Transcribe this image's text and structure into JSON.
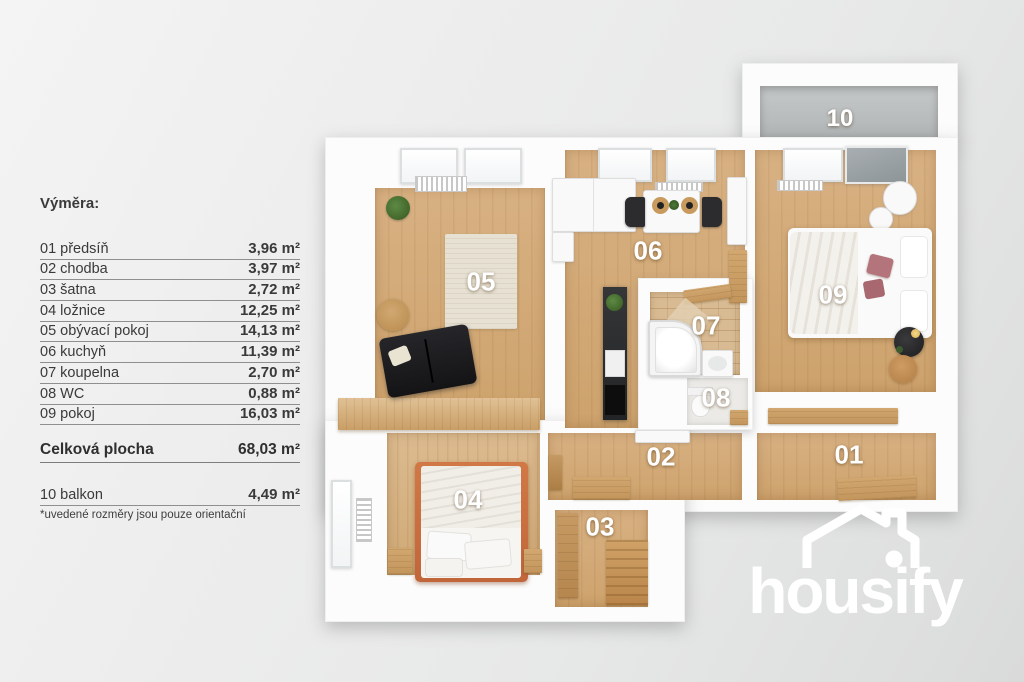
{
  "legend": {
    "title": "Výměra:",
    "rows": [
      {
        "label": "01 předsíň",
        "value": "3,96 m²"
      },
      {
        "label": "02 chodba",
        "value": "3,97 m²"
      },
      {
        "label": "03 šatna",
        "value": "2,72 m²"
      },
      {
        "label": "04 ložnice",
        "value": "12,25 m²"
      },
      {
        "label": "05 obývací pokoj",
        "value": "14,13 m²"
      },
      {
        "label": "06 kuchyň",
        "value": "11,39 m²"
      },
      {
        "label": "07 koupelna",
        "value": "2,70 m²"
      },
      {
        "label": "08 WC",
        "value": "0,88 m²"
      },
      {
        "label": "09 pokoj",
        "value": "16,03 m²"
      }
    ],
    "total": {
      "label": "Celková plocha",
      "value": "68,03 m²"
    },
    "balcony": {
      "label": "10 balkon",
      "value": "4,49 m²"
    },
    "footnote": "*uvedené rozměry jsou pouze orientační"
  },
  "plan": {
    "room_labels": [
      "01",
      "02",
      "03",
      "04",
      "05",
      "06",
      "07",
      "08",
      "09",
      "10"
    ]
  },
  "logo": {
    "text": "housify"
  },
  "colors": {
    "background": "#e9eaea",
    "wall": "#fcfcfc",
    "wood_floor": "#d2a873",
    "balcony_floor": "#bcc0c0",
    "bathroom_tile": "#d8bb93",
    "bed_frame_accent": "#c9703f",
    "pink_pillow": "#b3747b",
    "sofa_black": "#1d1d1f",
    "label_text": "#ffffff",
    "legend_text": "#3a3a3a"
  }
}
